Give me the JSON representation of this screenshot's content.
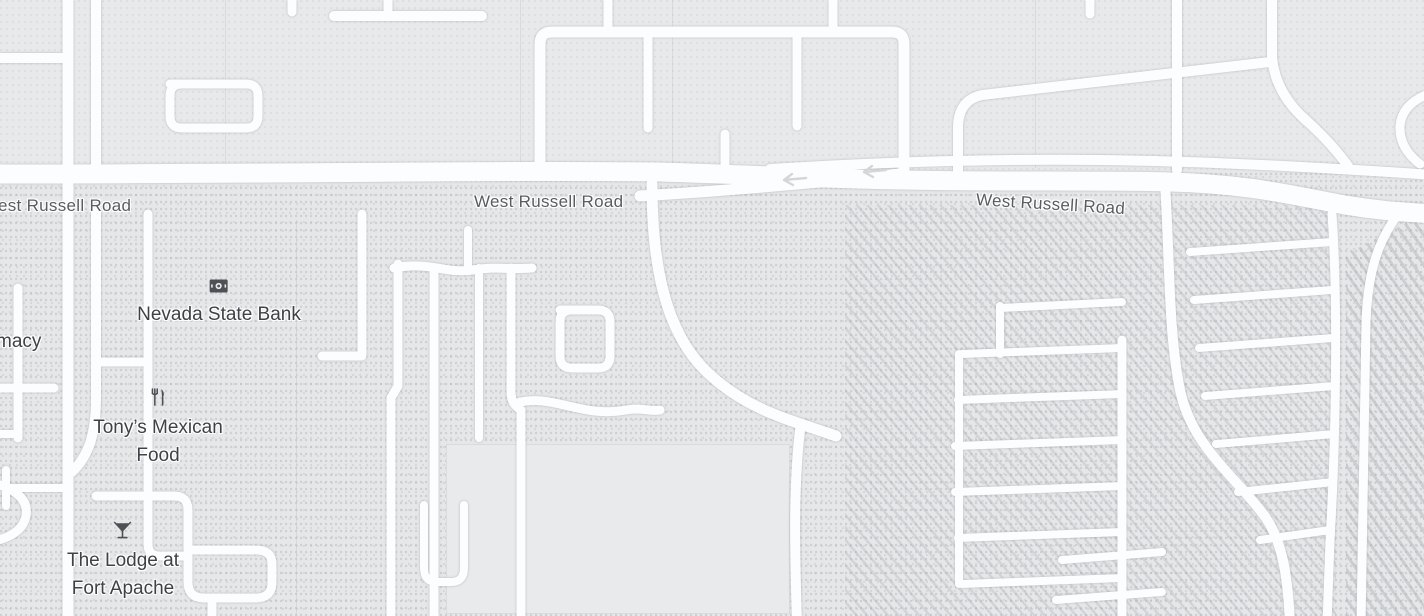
{
  "map": {
    "type": "street-map",
    "road_labels": [
      {
        "id": "west-russell-left",
        "text": "est Russell Road"
      },
      {
        "id": "west-russell-center",
        "text": "West Russell Road"
      },
      {
        "id": "west-russell-right",
        "text": "West Russell Road"
      }
    ],
    "pois": [
      {
        "id": "pharmacy-partial",
        "lines": [
          "macy"
        ]
      },
      {
        "id": "nevada-state-bank",
        "lines": [
          "Nevada State Bank"
        ],
        "icon": "bank-icon"
      },
      {
        "id": "tonys-mexican-food",
        "lines": [
          "Tony’s Mexican",
          "Food"
        ],
        "icon": "restaurant-icon"
      },
      {
        "id": "the-lodge-at-fort-apache",
        "lines": [
          "The Lodge at",
          "Fort Apache"
        ],
        "icon": "cocktail-icon"
      }
    ],
    "colors": {
      "background": "#e7e8ea",
      "road_fill": "#fcfdfe",
      "road_casing": "#dcdfe1",
      "poi_label": "#3e4145",
      "road_label": "#595c61",
      "icon": "#4d5055"
    }
  }
}
